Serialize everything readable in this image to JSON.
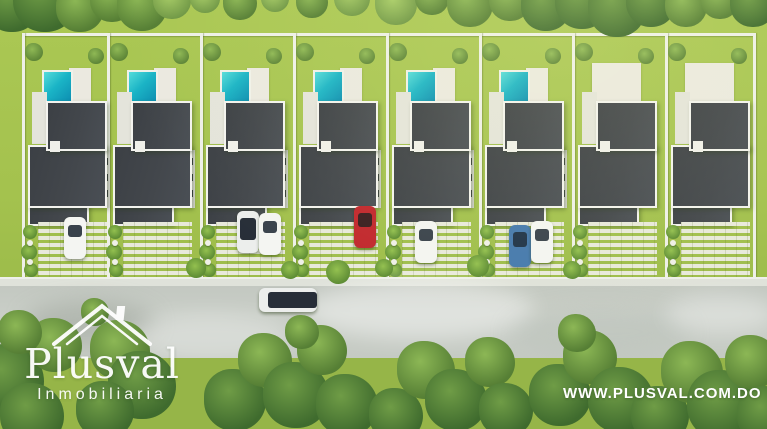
{
  "brand": {
    "logo_title": "Plusval",
    "logo_subtitle": "Inmobiliaria",
    "website": "WWW.PLUSVAL.COM.DO"
  },
  "palette": {
    "grass": "#a4c24e",
    "grass_bottom": "#96b548",
    "road": "#c7ccc5",
    "roof": "#43474c",
    "roof_border": "#f3f3ee",
    "pool_light": "#55dcda",
    "pool_dark": "#0c8cb0",
    "deck": "#ebe9e0",
    "fence": "#eef0e8",
    "paver": "#e8e9db",
    "car_white": "#f4f5f2",
    "car_red": "#c1272d",
    "car_blue": "#4579ad",
    "glass_dark": "#2b333d"
  },
  "scene": {
    "back_fence": {
      "x": 22,
      "y": 33,
      "w": 731
    },
    "lot_boundaries": [
      22,
      107,
      200,
      293,
      386,
      479,
      572,
      665,
      753
    ],
    "fence_top": 33,
    "fence_bottom": 277,
    "sidewalk": {
      "y": 277,
      "h": 9
    },
    "road": {
      "y": 286,
      "h": 72
    },
    "bottom_grass_y": 358,
    "lots": [
      {
        "x": 22,
        "w": 85,
        "pool": true,
        "cars": [
          {
            "kind": "white",
            "x": 64,
            "y": 217
          }
        ]
      },
      {
        "x": 107,
        "w": 93,
        "pool": true,
        "cars": []
      },
      {
        "x": 200,
        "w": 93,
        "pool": true,
        "cars": [
          {
            "kind": "white-glass",
            "x": 237,
            "y": 211
          },
          {
            "kind": "white",
            "x": 259,
            "y": 213
          }
        ]
      },
      {
        "x": 293,
        "w": 93,
        "pool": true,
        "cars": [
          {
            "kind": "red",
            "x": 354,
            "y": 206
          }
        ]
      },
      {
        "x": 386,
        "w": 93,
        "pool": true,
        "cars": [
          {
            "kind": "white",
            "x": 415,
            "y": 221
          }
        ]
      },
      {
        "x": 479,
        "w": 93,
        "pool": true,
        "cars": [
          {
            "kind": "blue",
            "x": 509,
            "y": 225
          },
          {
            "kind": "white",
            "x": 531,
            "y": 221
          }
        ]
      },
      {
        "x": 572,
        "w": 93,
        "pool": false,
        "cars": []
      },
      {
        "x": 665,
        "w": 88,
        "pool": false,
        "cars": []
      }
    ],
    "house_template": {
      "pool": {
        "dx": 20,
        "y": 70,
        "w": 27,
        "h": 31
      },
      "deck": {
        "dx": 47,
        "y": 68,
        "w": 22,
        "h": 33
      },
      "deck_nopool": {
        "dx": 20,
        "y": 63,
        "w": 49,
        "h": 38
      },
      "patio": {
        "dx": 10,
        "y": 92,
        "w": 15,
        "h": 52
      },
      "roof_upper": {
        "dx": 24,
        "y": 101,
        "w": 57,
        "h": 46
      },
      "roof_lower": {
        "dx": 6,
        "y": 145,
        "w": 75,
        "h": 59
      },
      "roof_tail": {
        "dx": 6,
        "y": 202,
        "w": 57,
        "h": 20
      },
      "notch": {
        "dx": 28,
        "y": 141,
        "w": 10,
        "h": 11
      },
      "windows": {
        "dx": 81,
        "dx_flipped": 7,
        "y": 150,
        "w": 7,
        "h": 58
      },
      "driveway": {
        "dx": 16,
        "y": 222,
        "w": 69,
        "h": 57
      },
      "plants_dx": 2,
      "palms": [
        {
          "dx": 12,
          "dy": 52,
          "r": 9
        },
        {
          "dx": 74,
          "dy": 56,
          "r": 8
        }
      ]
    },
    "car_size": {
      "w": 22,
      "h": 42
    },
    "road_car": {
      "x": 259,
      "y": 288,
      "w": 58,
      "h": 24,
      "kind": "white-glass"
    },
    "trees_top": [
      {
        "x": 12,
        "y": 4,
        "r": 28,
        "tone": "d"
      },
      {
        "x": 45,
        "y": 0,
        "r": 32,
        "tone": "d"
      },
      {
        "x": 80,
        "y": 8,
        "r": 24,
        "tone": "m"
      },
      {
        "x": 112,
        "y": 0,
        "r": 22,
        "tone": "m"
      },
      {
        "x": 142,
        "y": 6,
        "r": 25,
        "tone": "m"
      },
      {
        "x": 172,
        "y": 0,
        "r": 19,
        "tone": "l"
      },
      {
        "x": 205,
        "y": -2,
        "r": 15,
        "tone": "l"
      },
      {
        "x": 240,
        "y": 3,
        "r": 17,
        "tone": "m"
      },
      {
        "x": 275,
        "y": -2,
        "r": 14,
        "tone": "l"
      },
      {
        "x": 312,
        "y": 2,
        "r": 16,
        "tone": "m"
      },
      {
        "x": 352,
        "y": -2,
        "r": 18,
        "tone": "l"
      },
      {
        "x": 396,
        "y": 4,
        "r": 21,
        "tone": "l"
      },
      {
        "x": 432,
        "y": -2,
        "r": 17,
        "tone": "m"
      },
      {
        "x": 470,
        "y": 4,
        "r": 23,
        "tone": "m"
      },
      {
        "x": 510,
        "y": 0,
        "r": 21,
        "tone": "m"
      },
      {
        "x": 546,
        "y": 6,
        "r": 25,
        "tone": "d"
      },
      {
        "x": 582,
        "y": 2,
        "r": 27,
        "tone": "d"
      },
      {
        "x": 617,
        "y": 8,
        "r": 29,
        "tone": "d"
      },
      {
        "x": 651,
        "y": 2,
        "r": 25,
        "tone": "d"
      },
      {
        "x": 686,
        "y": 6,
        "r": 21,
        "tone": "m"
      },
      {
        "x": 720,
        "y": 0,
        "r": 19,
        "tone": "m"
      },
      {
        "x": 753,
        "y": 4,
        "r": 23,
        "tone": "d"
      }
    ],
    "trees_bottom": [
      {
        "x": 8,
        "y": 380,
        "r": 36,
        "tone": "d"
      },
      {
        "x": 32,
        "y": 415,
        "r": 32,
        "tone": "d"
      },
      {
        "x": 55,
        "y": 345,
        "r": 27,
        "tone": "m"
      },
      {
        "x": 20,
        "y": 332,
        "r": 22,
        "tone": "m"
      },
      {
        "x": 95,
        "y": 312,
        "r": 14,
        "tone": "m"
      },
      {
        "x": 120,
        "y": 350,
        "r": 30,
        "tone": "m"
      },
      {
        "x": 142,
        "y": 385,
        "r": 34,
        "tone": "d"
      },
      {
        "x": 105,
        "y": 410,
        "r": 29,
        "tone": "d"
      },
      {
        "x": 235,
        "y": 400,
        "r": 31,
        "tone": "d"
      },
      {
        "x": 265,
        "y": 360,
        "r": 27,
        "tone": "m"
      },
      {
        "x": 296,
        "y": 395,
        "r": 33,
        "tone": "d"
      },
      {
        "x": 322,
        "y": 350,
        "r": 25,
        "tone": "m"
      },
      {
        "x": 347,
        "y": 405,
        "r": 31,
        "tone": "d"
      },
      {
        "x": 302,
        "y": 332,
        "r": 17,
        "tone": "m"
      },
      {
        "x": 396,
        "y": 415,
        "r": 27,
        "tone": "d"
      },
      {
        "x": 426,
        "y": 370,
        "r": 29,
        "tone": "m"
      },
      {
        "x": 456,
        "y": 400,
        "r": 31,
        "tone": "d"
      },
      {
        "x": 490,
        "y": 362,
        "r": 25,
        "tone": "m"
      },
      {
        "x": 506,
        "y": 410,
        "r": 27,
        "tone": "d"
      },
      {
        "x": 560,
        "y": 395,
        "r": 31,
        "tone": "d"
      },
      {
        "x": 590,
        "y": 357,
        "r": 27,
        "tone": "m"
      },
      {
        "x": 621,
        "y": 400,
        "r": 33,
        "tone": "d"
      },
      {
        "x": 577,
        "y": 333,
        "r": 19,
        "tone": "m"
      },
      {
        "x": 660,
        "y": 415,
        "r": 29,
        "tone": "d"
      },
      {
        "x": 692,
        "y": 372,
        "r": 31,
        "tone": "m"
      },
      {
        "x": 722,
        "y": 405,
        "r": 35,
        "tone": "d"
      },
      {
        "x": 752,
        "y": 362,
        "r": 27,
        "tone": "m"
      },
      {
        "x": 766,
        "y": 415,
        "r": 29,
        "tone": "d"
      }
    ],
    "street_bushes": [
      {
        "x": 196,
        "y": 268,
        "r": 10
      },
      {
        "x": 290,
        "y": 270,
        "r": 9
      },
      {
        "x": 338,
        "y": 272,
        "r": 12
      },
      {
        "x": 384,
        "y": 268,
        "r": 9
      },
      {
        "x": 478,
        "y": 266,
        "r": 11
      },
      {
        "x": 572,
        "y": 270,
        "r": 9
      }
    ],
    "road_clouds": [
      {
        "x": 90,
        "y": 322,
        "w": 130,
        "h": 42,
        "c": "rgba(150,158,148,0.45)"
      },
      {
        "x": 210,
        "y": 338,
        "w": 160,
        "h": 48,
        "c": "rgba(255,255,255,0.30)"
      },
      {
        "x": 420,
        "y": 310,
        "w": 230,
        "h": 58,
        "c": "rgba(255,255,255,0.42)"
      },
      {
        "x": 600,
        "y": 332,
        "w": 180,
        "h": 48,
        "c": "rgba(185,192,183,0.38)"
      },
      {
        "x": 720,
        "y": 314,
        "w": 110,
        "h": 40,
        "c": "rgba(255,255,255,0.32)"
      }
    ],
    "logo_pos": {
      "x": 22,
      "y": 298,
      "w": 160
    },
    "url_pos": {
      "x": 563,
      "y": 385
    }
  }
}
